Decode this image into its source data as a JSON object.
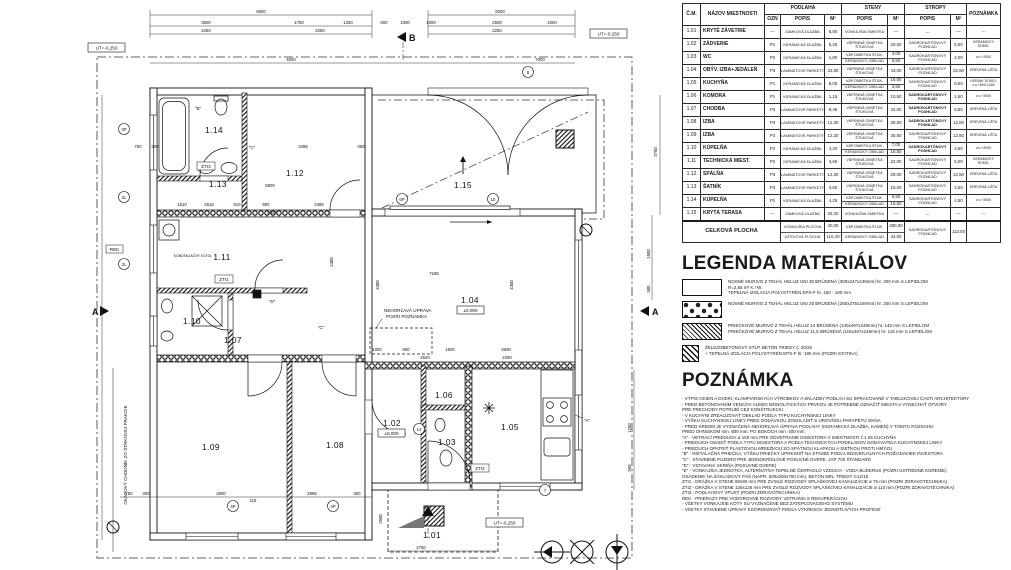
{
  "schedule": {
    "headers": {
      "cm": "Č.M.",
      "name": "NÁZOV MIESTNOSTI",
      "podlaha": "PODLAHA",
      "steny": "STENY",
      "stropy": "STROPY",
      "poznamka": "POZNÁMKA",
      "ozn": "OZN",
      "popis": "POPIS",
      "m2": "M²"
    },
    "rows": [
      {
        "cm": "1.01",
        "name": "KRYTÉ ZÁVETRIE",
        "ozn": "—",
        "podlaha": "ZÁMKOVÁ DLAŽBA",
        "podlaha_m2": "6,80",
        "steny": [
          [
            "VONKAJŠIA OMIETKA",
            "—"
          ]
        ],
        "stropy": "—",
        "stropy_m2": "—",
        "poznamka": "—",
        "stropy_b": false
      },
      {
        "cm": "1.02",
        "name": "ZÁDVERIE",
        "ozn": "P1",
        "podlaha": "KERAMICKÁ DLAŽBA",
        "podlaha_m2": "5,25",
        "steny": [
          [
            "VÁPENNÁ OMIETKA ŠTUKOVÁ",
            "20,50"
          ]
        ],
        "stropy": "SADROKARTÓNOVÝ PODHĽAD",
        "stropy_m2": "5,50",
        "poznamka": "KERAMICKÝ SOKEL",
        "stropy_b": false
      },
      {
        "cm": "1.03",
        "name": "WC",
        "ozn": "P2",
        "podlaha": "KERAMICKÁ DLAŽBA",
        "podlaha_m2": "1,80",
        "steny": [
          [
            "VÁP.OMIETKA ŠTUK.",
            "4,00"
          ],
          [
            "KERAMICKÝ OBKLAD",
            "6,50"
          ]
        ],
        "stropy": "SADROKARTÓNOVÝ PODHĽAD",
        "stropy_m2": "2,00",
        "poznamka": "v.o.+2000",
        "stropy_b": false
      },
      {
        "cm": "1.04",
        "name": "OBÝV. IZBA+JEDÁLEŇ",
        "ozn": "P3",
        "podlaha": "LAMINÁTOVÉ PARKETY",
        "podlaha_m2": "32,50",
        "steny": [
          [
            "VÁPENNÁ OMIETKA ŠTUKOVÁ",
            "43,00"
          ]
        ],
        "stropy": "SADROKARTÓNOVÝ PODHĽAD",
        "stropy_m2": "32,50",
        "poznamka": "DREVENÁ LIŠTA",
        "stropy_b": false
      },
      {
        "cm": "1.05",
        "name": "KUCHYŇA",
        "ozn": "P1",
        "podlaha": "KERAMICKÁ DLAŽBA",
        "podlaha_m2": "8,05",
        "steny": [
          [
            "VÁP.OMIETKA ŠTUK.",
            "16,00"
          ],
          [
            "KERAMICKÝ OBKLAD",
            "3,50"
          ]
        ],
        "stropy": "SADROKARTÓNOVÝ PODHĽAD",
        "stropy_m2": "8,50",
        "poznamka": "KERAM. SOKEL v.o.+800-1400",
        "stropy_b": false
      },
      {
        "cm": "1.06",
        "name": "KOMORA",
        "ozn": "P1",
        "podlaha": "KERAMICKÁ DLAŽBA",
        "podlaha_m2": "1,15",
        "steny": [
          [
            "VÁPENNÁ OMIETKA ŠTUKOVÁ",
            "10,50"
          ]
        ],
        "stropy": "SADROKARTÓNOVÝ PODHĽAD",
        "stropy_m2": "1,50",
        "poznamka": "v.o.+2000",
        "stropy_b": true
      },
      {
        "cm": "1.07",
        "name": "CHODBA",
        "ozn": "P3",
        "podlaha": "LAMINÁTOVÉ PARKETY",
        "podlaha_m2": "8,45",
        "steny": [
          [
            "VÁPENNÁ OMIETKA ŠTUKOVÁ",
            "32,00"
          ]
        ],
        "stropy": "SADROKARTÓNOVÝ PODHĽAD",
        "stropy_m2": "8,50",
        "poznamka": "DREVENÁ LIŠTA",
        "stropy_b": true
      },
      {
        "cm": "1.08",
        "name": "IZBA",
        "ozn": "P3",
        "podlaha": "LAMINÁTOVÉ PARKETY",
        "podlaha_m2": "12,30",
        "steny": [
          [
            "VÁPENNÁ OMIETKA ŠTUKOVÁ",
            "36,50"
          ]
        ],
        "stropy": "SADROKARTÓNOVÝ PODHĽAD",
        "stropy_m2": "12,50",
        "poznamka": "DREVENÁ LIŠTA",
        "stropy_b": true
      },
      {
        "cm": "1.09",
        "name": "IZBA",
        "ozn": "P3",
        "podlaha": "LAMINÁTOVÉ PARKETY",
        "podlaha_m2": "12,20",
        "steny": [
          [
            "VÁPENNÁ OMIETKA ŠTUKOVÁ",
            "35,50"
          ]
        ],
        "stropy": "SADROKARTÓNOVÝ PODHĽAD",
        "stropy_m2": "12,50",
        "poznamka": "DREVENÁ LIŠTA",
        "stropy_b": false
      },
      {
        "cm": "1.10",
        "name": "KÚPEĽŇA",
        "ozn": "P2",
        "podlaha": "KERAMICKÁ DLAŽBA",
        "podlaha_m2": "4,20",
        "steny": [
          [
            "VÁP.OMIETKA ŠTUK.",
            "7,00"
          ],
          [
            "KERAMICKÝ OBKLAD",
            "16,50"
          ]
        ],
        "stropy": "SADROKARTÓNOVÝ PODHĽAD",
        "stropy_m2": "4,50",
        "poznamka": "v.o.+2000",
        "stropy_b": true
      },
      {
        "cm": "1.11",
        "name": "TECHNICKÁ MIEST.",
        "ozn": "P2",
        "podlaha": "KERAMICKÁ DLAŽBA",
        "podlaha_m2": "4,65",
        "steny": [
          [
            "VÁPENNÁ OMIETKA ŠTUKOVÁ",
            "22,00"
          ]
        ],
        "stropy": "SADROKARTÓNOVÝ PODHĽAD",
        "stropy_m2": "5,00",
        "poznamka": "KERAMICKÝ SOKEL",
        "stropy_b": false
      },
      {
        "cm": "1.12",
        "name": "SPÁLŇA",
        "ozn": "P3",
        "podlaha": "LAMINÁTOVÉ PARKETY",
        "podlaha_m2": "12,30",
        "steny": [
          [
            "VÁPENNÁ OMIETKA ŠTUKOVÁ",
            "29,00"
          ]
        ],
        "stropy": "SADROKARTÓNOVÝ PODHĽAD",
        "stropy_m2": "12,50",
        "poznamka": "DREVENÁ LIŠTA",
        "stropy_b": false
      },
      {
        "cm": "1.13",
        "name": "ŠATNÍK",
        "ozn": "P3",
        "podlaha": "LAMINÁTOVÉ PARKETY",
        "podlaha_m2": "3,50",
        "steny": [
          [
            "VÁPENNÁ OMIETKA ŠTUKOVÁ",
            "18,00"
          ]
        ],
        "stropy": "SADROKARTÓNOVÝ PODHĽAD",
        "stropy_m2": "3,50",
        "poznamka": "DREVENÁ LIŠTA",
        "stropy_b": false
      },
      {
        "cm": "1.14",
        "name": "KÚPEĽŇA",
        "ozn": "P2",
        "podlaha": "KERAMICKÁ DLAŽBA",
        "podlaha_m2": "4,25",
        "steny": [
          [
            "VÁP.OMIETKA ŠTUK.",
            "6,50"
          ],
          [
            "KERAMICKÝ OBKLAD",
            "15,50"
          ]
        ],
        "stropy": "SADROKARTÓNOVÝ PODHĽAD",
        "stropy_m2": "4,50",
        "poznamka": "v.o.+2000",
        "stropy_b": false
      },
      {
        "cm": "1.15",
        "name": "KRYTÁ TERASA",
        "ozn": "—",
        "podlaha": "ZÁMKOVÁ DLAŽBA",
        "podlaha_m2": "33,20",
        "steny": [
          [
            "VONKAJŠIA OMIETKA",
            "—"
          ]
        ],
        "stropy": "—",
        "stropy_m2": "—",
        "poznamka": "—",
        "stropy_b": false
      }
    ],
    "total": {
      "label": "CELKOVÁ PLOCHA",
      "podlaha": [
        [
          "VONKAJŠIA PLOCHA",
          "40,00"
        ],
        [
          "ÚŽITKOVÁ PLOCHA",
          "110,40"
        ]
      ],
      "steny": [
        [
          "VÁP.OMIETKA ŠTUK.",
          "280,50"
        ],
        [
          "KERAMICKÝ OBKLAD",
          "44,00"
        ]
      ],
      "stropy": "SADROKARTÓNOVÝ PODHĽAD",
      "stropy_m2": "113,50",
      "poznamka": ""
    }
  },
  "legend": {
    "title": "LEGENDA MATERIÁLOV",
    "items": [
      {
        "icon": "wall-heluz30-swatch",
        "lines": [
          "NOSNÉ MURIVO Z TEHÁL HELUZ UNI 30 BRÚSENÁ (300x247x249mm) hr. 300 mm S LEPIDLOM",
          "R=2,65 m² K / W",
          "TEPELNÁ IZOLÁCIA POLYSTYRÉN EPS-F hr. 160 - 180 mm"
        ]
      },
      {
        "icon": "wall-heluz25-swatch",
        "lines": [
          "NOSNÉ MURIVO Z TEHÁL HELUZ UNI 25 BRÚSENÁ (250x375x249mm) hr. 250 mm S LEPIDLOM"
        ]
      },
      {
        "icon": "wall-partition-swatch",
        "lines": [
          "PRIEČKOVÉ MURIVO Z TEHÁL HELUZ 14 BRÚSENÁ (140x497x249mm) hr. 140 mm S LEPIDLOM",
          "PRIEČKOVÉ MURIVO Z TEHÁL HELUZ 11,5 BRÚSENÁ (115x497x249mm) hr. 115 mm S LEPIDLOM"
        ]
      },
      {
        "icon": "concrete-column-swatch",
        "lines": [
          "ŽELEZOBETÓNOVÝ STĹP, BETÓN TRIEDY C 20/25",
          "+ TEPELNÁ IZOLÁCIA POLYSTYRÉN EPS-F hr. 180 mm (POZRI STATIKA)"
        ]
      }
    ]
  },
  "notes": {
    "title": "POZNÁMKA",
    "lines": [
      "- VÝPIS OKIEN A DVERÍ, KLAMPIARSKYCH VÝROBKOV A SKLADBY PODLÁH SÚ SPRACOVANÉ V TABUĽKOVEJ ČASTI ARCHITEKTÚRY",
      "- PRED BETÓNOVANÍM VENCOV ALEBO MONOLITICKÝCH PRVKOV JE POTREBNÉ OZNAČIŤ MIESTA A VYNECHAŤ OTVORY",
      "  PRE PRECHODY POTRUBÍ CEZ KONŠTRUKCIU",
      "- V KUCHYNI ZREALIZOVAŤ OBKLAD PODĽA TYPU KUCHYNSKEJ LINKY",
      "- VÝŠKU KUCHYNSKEJ LINKY PRED DODÁVKOU ZOSÚLADIŤ S ÚROVŇOU PARAPETU OKNA",
      "- PRED KRBOM JE VYZNAČENÁ NEHORĽAVÁ ÚPRAVA PODLAHY (KERAMICKÁ DLAŽBA, KAMEŇ) V TOMTO ROZSAHU:",
      "  PRED OHNISKOM min. 800 mm, PO BOKOCH min. 400 mm",
      "\"A\" - VETRACÍ PRIEDUCH ø 150 mm PRE ODVETRANIE DIGESTORA V MIESTNOSTI č.1.05 KUCHYŇA",
      "      - PRIEDUCH OSADIŤ PODĽA TYPU DIGESTORA A PODĽA TECHNICKÝCH PODKLADOV DODÁVATEĽA KUCHYNSKEJ LINKY",
      "      - PRIEDUCH OPATRIŤ PLASTOVOU MRIEŽKOU SO SPÄTNOU KLAPKOU A SIEŤKOU PROTI HMYZU",
      "\"B\" - INŠTALAČNÁ PRIEČKA, VÝŠKU PRIEČKY UPRESNIŤ NA STAVBE PODĽA INDIVIDUÁLNYCH POŽIADAVIEK INVESTORA",
      "\"C\" - STAVEBNÉ PÚZDRO PRE JEDNOKRÍDLOVÉ POSUVNÉ DVERE, JAP 700 ŠTANDARD",
      "\"D\" - VSTAVANÁ SKRIŇA (POSUVNÉ DVERE)",
      "\"E\" - VONKAJŠIA JEDNOTKA, ALTERNATÍVA TEPELNÉ ČERPADLO VZDUCH - VODA BUDERUS (POZRI ÚSTREDNÉ KÚRENIE)",
      "      OSADENIE NA ZÁKLADOVÝ PÁS (NAPR. 500x200x700 mm), BETÓN MIN. TRIEDY C12/15",
      "ZTI1 - DRÁŽKA V STENE 90x90 mm PRE ZVISLÉ ROZVODY SPLAŠKOVEJ KANALIZÁCIE ø 75 mm (POZRI ZDRAVOTECHNIKA)",
      "ZTI2 - DRÁŽKA V STENE 125x125 mm PRE ZVISLÉ ROZVODY SPLAŠKOVEJ KANALIZÁCIE ø 110 mm (POZRI ZDRAVOTECHNIKA)",
      "ZTI3 - PODLAHOVÝ VPUST (POZRI ZDRAVOTECHNIKA)",
      "REK - PRIERAZY PRE VODOROVNÉ ROZVODY VETRANIA S REKUPERÁCIOU",
      "- VŠETKY VONKAJŠIE KÓTY SÚ VYZNAČENÉ BEZ ZATEPĽOVACIEHO SYSTÉMU",
      "- VŠETKY STAVEBNÉ ÚPRAVY KOORDINOVAŤ PODĽA VÝKRESOV JEDNOTLIVÝCH PROFESIÍ"
    ]
  },
  "plan": {
    "rooms": {
      "r101": "1.01",
      "r102": "1.02",
      "r103": "1.03",
      "r104": "1.04",
      "r105": "1.05",
      "r106": "1.06",
      "r107": "1.07",
      "r108": "1.08",
      "r109": "1.09",
      "r110": "1.10",
      "r111": "1.11",
      "r112": "1.12",
      "r113": "1.13",
      "r114": "1.14",
      "r115": "1.15"
    },
    "labels": {
      "ut": "UT=-0,250",
      "zero": "±0,000",
      "b": "B",
      "a": "A",
      "rek": "REK",
      "zti1": "ZTI1",
      "zti2": "ZTI2",
      "zti3": "ZTI3",
      "kotol": "KONDENZAČNÝ KOTOL",
      "nehorlava1": "NEHORĽAVÁ ÚPRAVA",
      "nehorlava2": "POZRI POZNÁMKA",
      "chodnik": "OKAPOVÝ CHODNÍK ZO ŠTRKOVEJ FRAKCIE",
      "qa": "\"A\"",
      "qb": "\"B\"",
      "qc": "\"C\"",
      "qd": "\"D\""
    },
    "markers": [
      "3P",
      "2L",
      "2L",
      "4P",
      "4P",
      "6P",
      "10",
      "8",
      "7",
      "14"
    ],
    "dims": [
      "6500",
      "3500",
      "1750",
      "1250",
      "500",
      "1000",
      "2250",
      "2250",
      "6000",
      "1000",
      "2500",
      "1000",
      "2250",
      "4600",
      "7000",
      "750",
      "300",
      "3485",
      "300",
      "5800",
      "1510",
      "2615",
      "910",
      "900",
      "2385",
      "2020",
      "7185",
      "1000",
      "900",
      "1500",
      "2600",
      "2620",
      "2250",
      "750",
      "300",
      "2800",
      "115",
      "2985",
      "300",
      "2750",
      "3750",
      "1500",
      "500",
      "1250",
      "950",
      "2500",
      "2400",
      "4300",
      "4300"
    ]
  }
}
